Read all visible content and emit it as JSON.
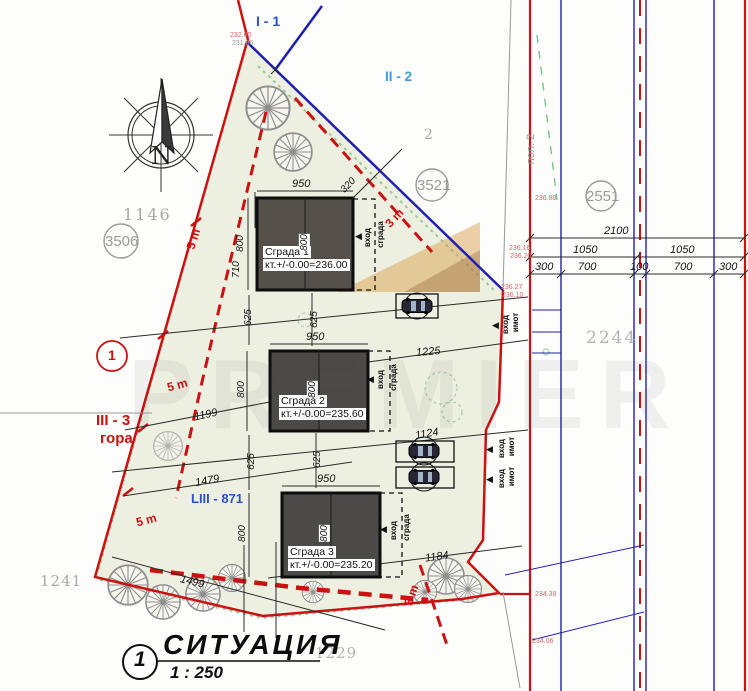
{
  "annotations": {
    "zone_i1": "I - 1",
    "zone_ii2": "II - 2",
    "zone_iii3_line1": "III - 3",
    "zone_iii3_line2": "гора",
    "zone_liii": "LIII - 871",
    "pol2": "пол. 2",
    "north_letter": "N"
  },
  "parcels": {
    "n1146": "1146",
    "n3506": "3506",
    "n3521": "3521",
    "n2551": "2551",
    "n2244": "2244",
    "n1241": "1241",
    "n1229": "1229",
    "n2": "2",
    "site_number": "1"
  },
  "buildings": [
    {
      "name": "Сграда 1",
      "elevation": "кт.+/-0.00=236.00"
    },
    {
      "name": "Сграда 2",
      "elevation": "кт.+/-0.00=235.60"
    },
    {
      "name": "Сграда 3",
      "elevation": "кт.+/-0.00=235.20"
    }
  ],
  "entrance_labels": {
    "vhod": "вход",
    "sgrada": "сграда",
    "imot": "имот"
  },
  "icons": {
    "entrance_arrow_glyph": "◀"
  },
  "dims": {
    "road_total": "2100",
    "road_half_left": "1050",
    "road_half_right": "1050",
    "road_seg": [
      "300",
      "700",
      "100",
      "700",
      "300"
    ],
    "b1_w": "950",
    "b2_w": "950",
    "b3_w": "950",
    "b1_h_left": "800",
    "b1_h_mid": "800",
    "b1_left_710": "710",
    "b1_diag_320": "320",
    "b2_h_left": "800",
    "b2_h_mid": "800",
    "b3_h_left": "800",
    "b3_h_mid": "800",
    "gap12_left": "625",
    "gap12_mid": "625",
    "gap23_left": "625",
    "gap23_mid": "625",
    "d1225": "1225",
    "d1124": "1124",
    "d1184": "1184",
    "d1199": "1199",
    "d1479": "1479",
    "d1499": "1499",
    "setback5": "5 m",
    "setback3": "3 m"
  },
  "spot_elevations": {
    "e1": "232.60",
    "e2": "231.86",
    "e3": "236.16",
    "e4": "236.20",
    "e5": "236.27",
    "e6": "236.10",
    "e7": "236.88",
    "e8": "234.38",
    "e9": "234.06"
  },
  "title_block": {
    "drawing_number": "1",
    "title": "СИТУАЦИЯ",
    "scale": "1 : 250"
  },
  "watermark": {
    "text": "PREMIER"
  },
  "colors": {
    "boundary_red": "#cc1111",
    "boundary_blue": "#1f1fb4",
    "label_blue": "#3d9bdc",
    "zone_blue": "#2a4fd0",
    "grey_label": "#a8a8a8",
    "site_fill": "#edf0e1",
    "building_fill": "#4b4a48",
    "vegetation_green": "#8fc79a"
  }
}
